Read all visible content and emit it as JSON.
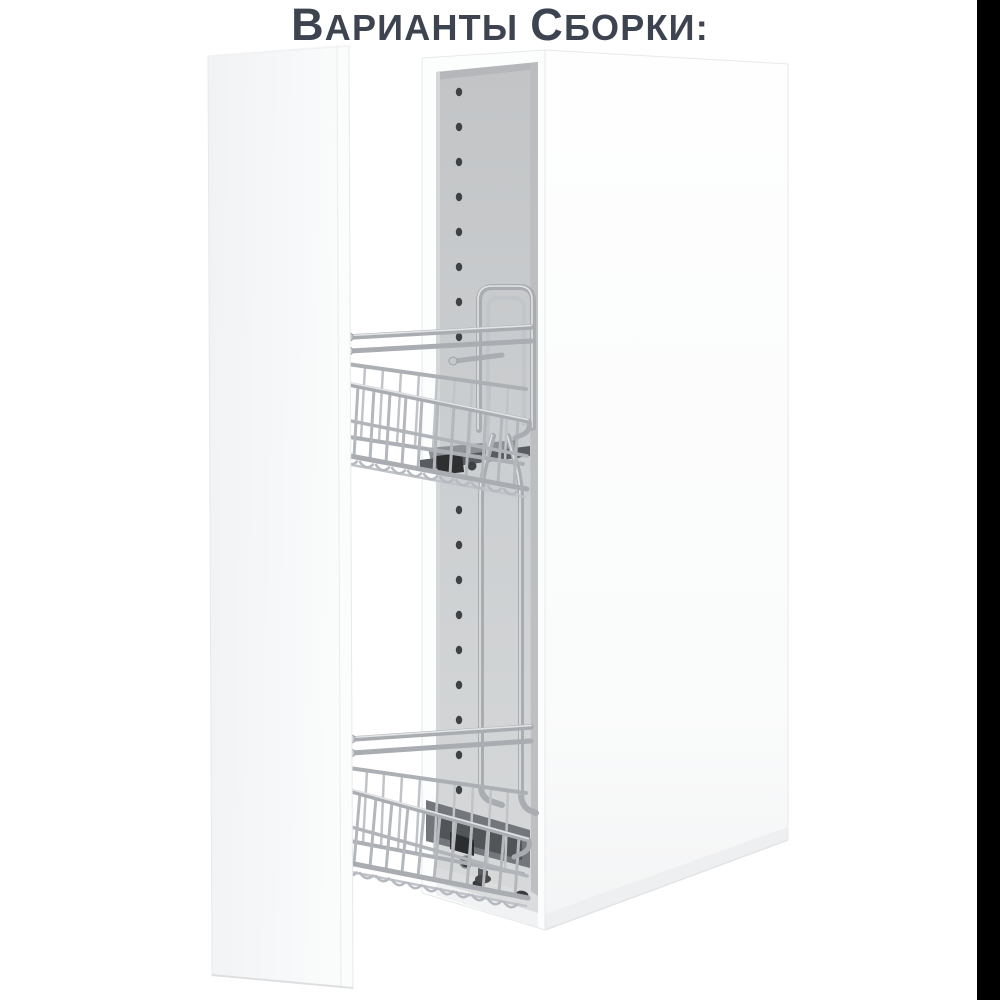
{
  "title": {
    "full_text": "ВАРИАНТЫ СБОРКИ:",
    "lead_1": "В",
    "rest_1": "АРИАНТЫ",
    "lead_2": "С",
    "rest_2": "БОРКИ:",
    "color": "#3d4450"
  },
  "figure": {
    "alt": "Белый узкий шкаф со снятой дверцей и двухъярусной выдвижной хромированной корзиной-бутылочницей",
    "basket_tiers": 2,
    "shelf_pin_hole_count": 17
  },
  "colors": {
    "background": "#ffffff",
    "title_text": "#3d4450",
    "cabinet_white": "#fbfcfd",
    "door_white": "#f6f7f8",
    "interior_gray": "#c9cccd",
    "chrome": "#aeb2b6",
    "chrome_highlight": "#e0e2e4",
    "mechanism_dark": "#55585c",
    "hole_dark": "#3f4244",
    "right_strip": "#000000"
  }
}
